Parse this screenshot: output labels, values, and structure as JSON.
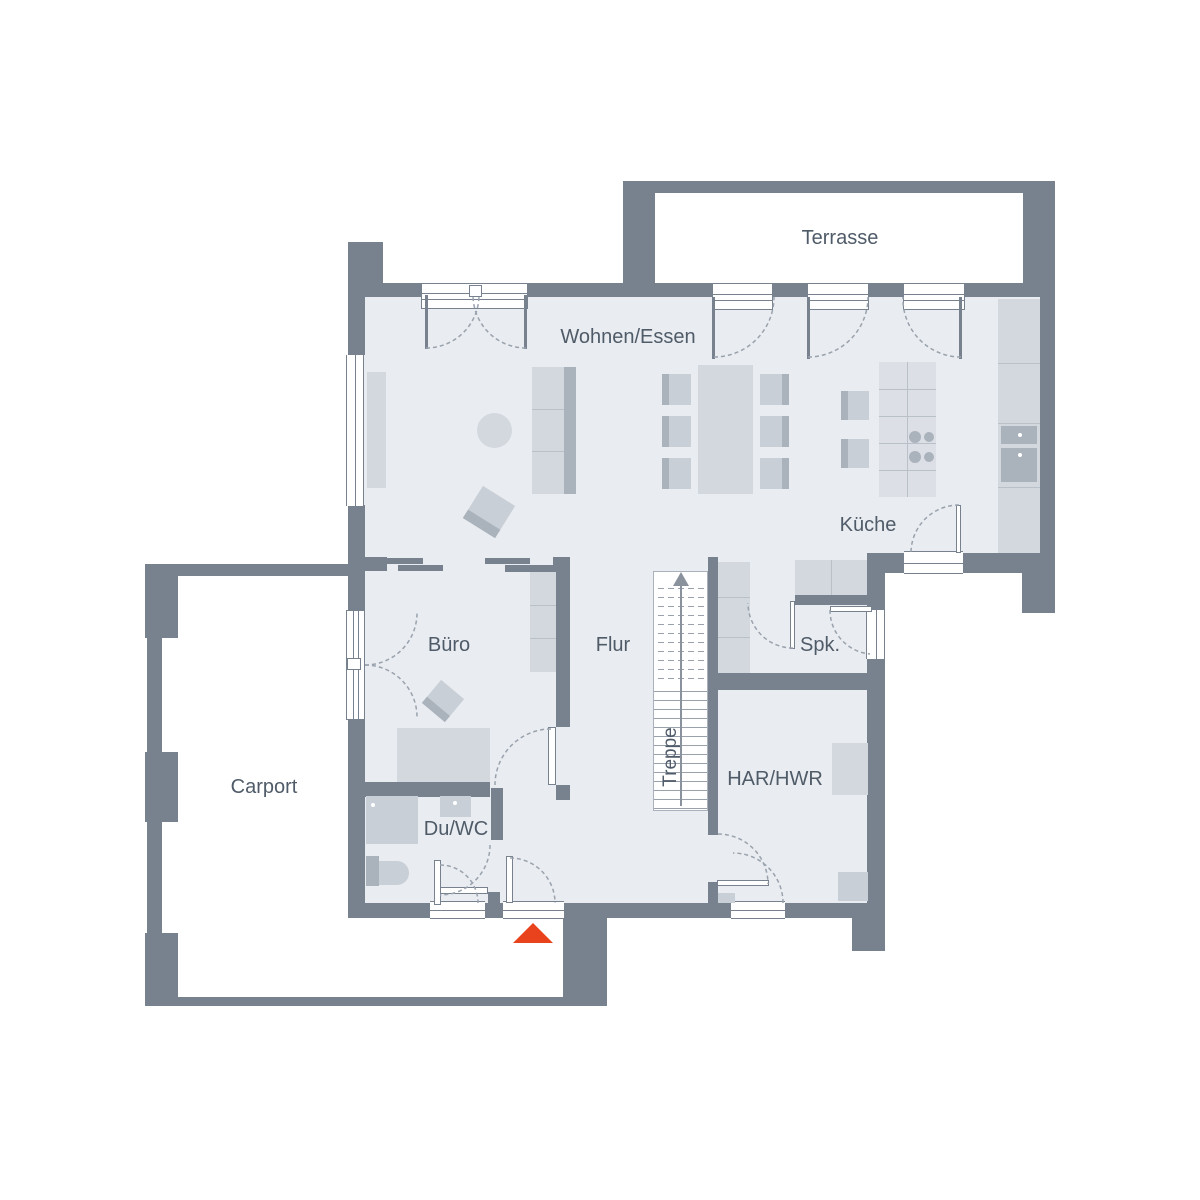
{
  "plan": {
    "title": "Erdgeschoss Grundriss",
    "rooms": [
      {
        "id": "terrasse",
        "label": "Terrasse"
      },
      {
        "id": "wohnen_essen",
        "label": "Wohnen/Essen"
      },
      {
        "id": "kueche",
        "label": "Küche"
      },
      {
        "id": "buero",
        "label": "Büro"
      },
      {
        "id": "flur",
        "label": "Flur"
      },
      {
        "id": "spk",
        "label": "Spk."
      },
      {
        "id": "treppe",
        "label": "Treppe"
      },
      {
        "id": "har_hwr",
        "label": "HAR/HWR"
      },
      {
        "id": "du_wc",
        "label": "Du/WC"
      },
      {
        "id": "carport",
        "label": "Carport"
      }
    ],
    "entrance_marker": {
      "shape": "triangle-up",
      "meaning": "entrance",
      "color": "#e8431c"
    },
    "stair_direction": "up"
  },
  "colors": {
    "wall": "#78828f",
    "floor": "#e9ecf0",
    "text": "#4f5b68",
    "arc": "#99a2ad",
    "furn1": "#d3d8de",
    "furn2": "#c9cfd6",
    "furn3": "#aab2bc",
    "island": "#dcdfe5",
    "line": "#b9c0c8",
    "tread": "#98a1ac",
    "accent": "#e8431c",
    "paper": "#ffffff"
  }
}
